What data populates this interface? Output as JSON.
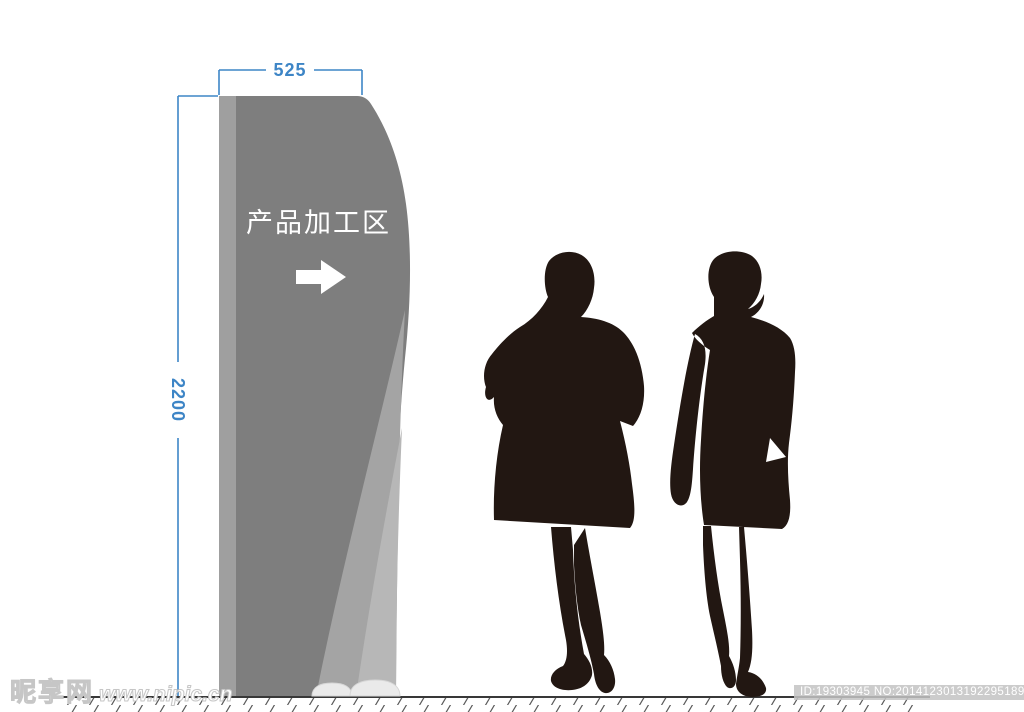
{
  "sign": {
    "panel_text": "产品加工区",
    "arrow_icon": "right-arrow",
    "base_pads": 2
  },
  "dimensions": {
    "width_label": "525",
    "height_label": "2200"
  },
  "figures": [
    "person-in-coat-silhouette",
    "person-in-dress-silhouette"
  ],
  "watermark": {
    "site_name": "昵享网",
    "site_url": "www.nipic.cn"
  },
  "footer_id": {
    "text": "ID:19303945 NO:20141230131922951893"
  },
  "colors": {
    "pylon_body": "#7e7e7e",
    "pylon_edge": "#9f9f9f",
    "swoosh_mid": "#a4a4a4",
    "swoosh_light": "#b7b7b7",
    "base_pad": "#eaeaea",
    "base_pad_stroke": "#d6d6d6",
    "silhouette": "#221712",
    "dimension_blue": "#3d85c6",
    "arrow_white": "#ffffff",
    "ground_line": "#383838",
    "hatch": "#5a5a5a"
  }
}
